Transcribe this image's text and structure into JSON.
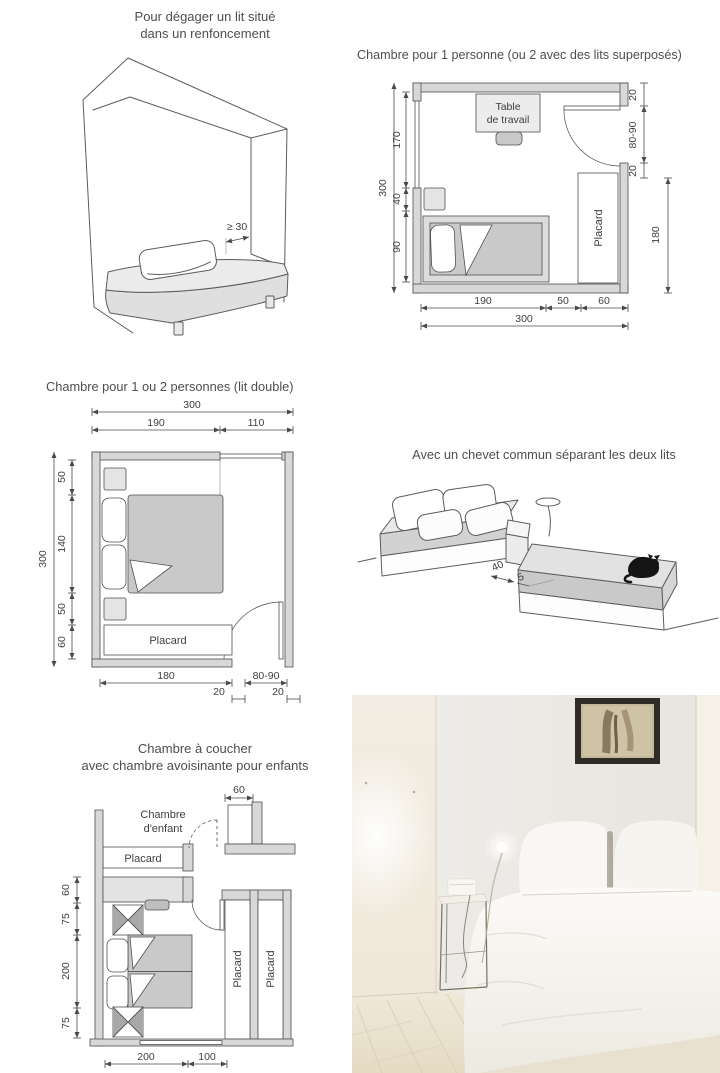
{
  "palette": {
    "ink": "#4f4f4f",
    "wall_fill": "#d8d8d8",
    "bed_fill": "#c9c9c9",
    "text": "#4a4a4a",
    "paper": "#ffffff"
  },
  "alcove": {
    "title_line1": "Pour dégager un lit situé",
    "title_line2": "dans un renfoncement",
    "dim_clearance": "≥ 30"
  },
  "plan1": {
    "title": "Chambre pour 1 personne (ou 2 avec des lits superposés)",
    "desk_label_line1": "Table",
    "desk_label_line2": "de travail",
    "placard_label": "Placard",
    "dims": {
      "left_total": "300",
      "left_window": "170",
      "left_nightstand": "40",
      "left_bed": "90",
      "right_top": "20",
      "right_door": "80-90",
      "right_post": "20",
      "right_placard": "180",
      "bottom_bed": "190",
      "bottom_passage": "50",
      "bottom_placard": "60",
      "bottom_total": "300"
    }
  },
  "plan2": {
    "title": "Chambre pour 1 ou 2 personnes (lit double)",
    "placard_label": "Placard",
    "dims": {
      "top_total": "300",
      "top_left": "190",
      "top_right": "110",
      "left_total": "300",
      "left_top": "50",
      "left_bed": "140",
      "left_bottom": "50",
      "left_placard": "60",
      "bottom_placard": "180",
      "bottom_gap_left": "20",
      "bottom_door": "80-90",
      "bottom_gap_right": "20"
    }
  },
  "twin_beds": {
    "title": "Avec un chevet commun séparant les deux lits",
    "dims": {
      "chevet_depth": "40",
      "gap": "5"
    }
  },
  "plan3": {
    "title_line1": "Chambre à coucher",
    "title_line2": "avec chambre avoisinante pour enfants",
    "child_room_label_line1": "Chambre",
    "child_room_label_line2": "d'enfant",
    "placard_child_label": "Placard",
    "placard_left_label": "Placard",
    "placard_right_label": "Placard",
    "dims": {
      "closet_width": "60",
      "left_wardrobe": "60",
      "left_table_top": "75",
      "left_beds": "200",
      "left_table_bottom": "75",
      "bottom_beds": "200",
      "bottom_passage": "100"
    }
  }
}
